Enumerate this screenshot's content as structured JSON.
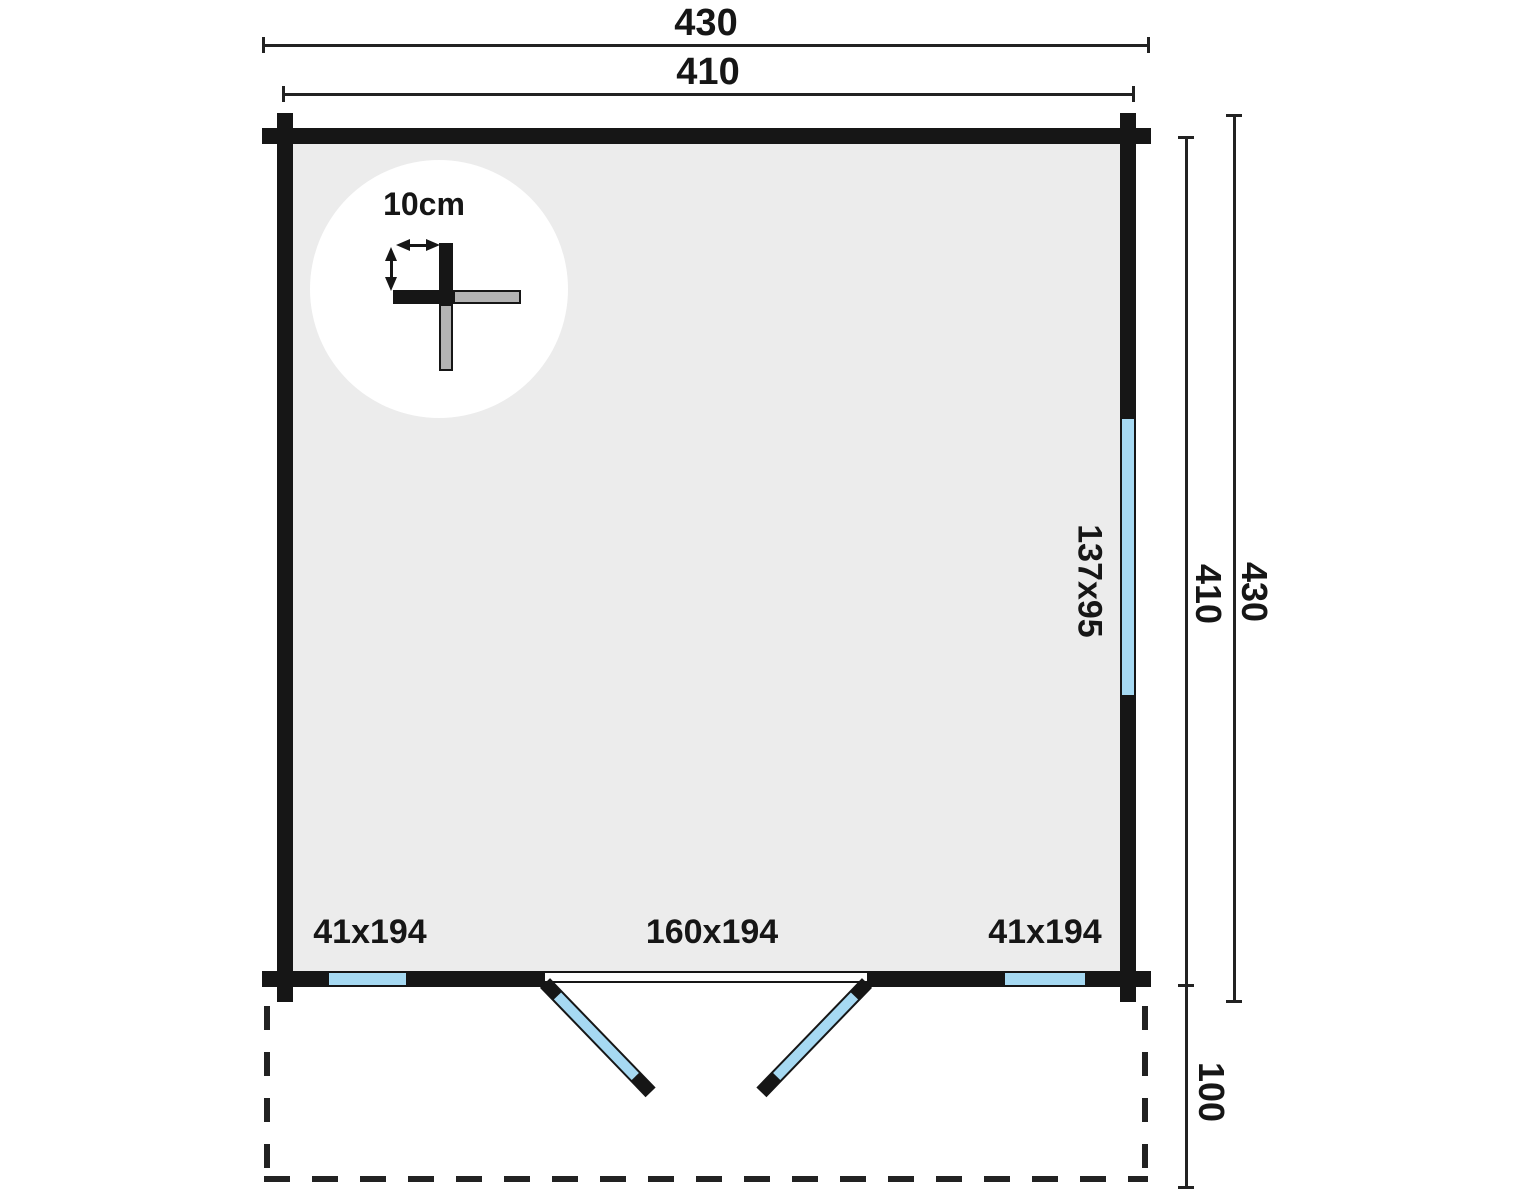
{
  "labels": {
    "width_outer": "430",
    "width_inner": "410",
    "height_inner": "410",
    "height_outer": "430",
    "terrace_depth": "100",
    "detail_thickness": "10cm",
    "side_window": "137x95",
    "left_window": "41x194",
    "door": "160x194",
    "right_window": "41x194"
  },
  "colors": {
    "wall": "#161616",
    "glass": "#a6d9f2",
    "floor": "#ececec",
    "detail_gray": "#b3b3b3",
    "line": "#222222"
  }
}
